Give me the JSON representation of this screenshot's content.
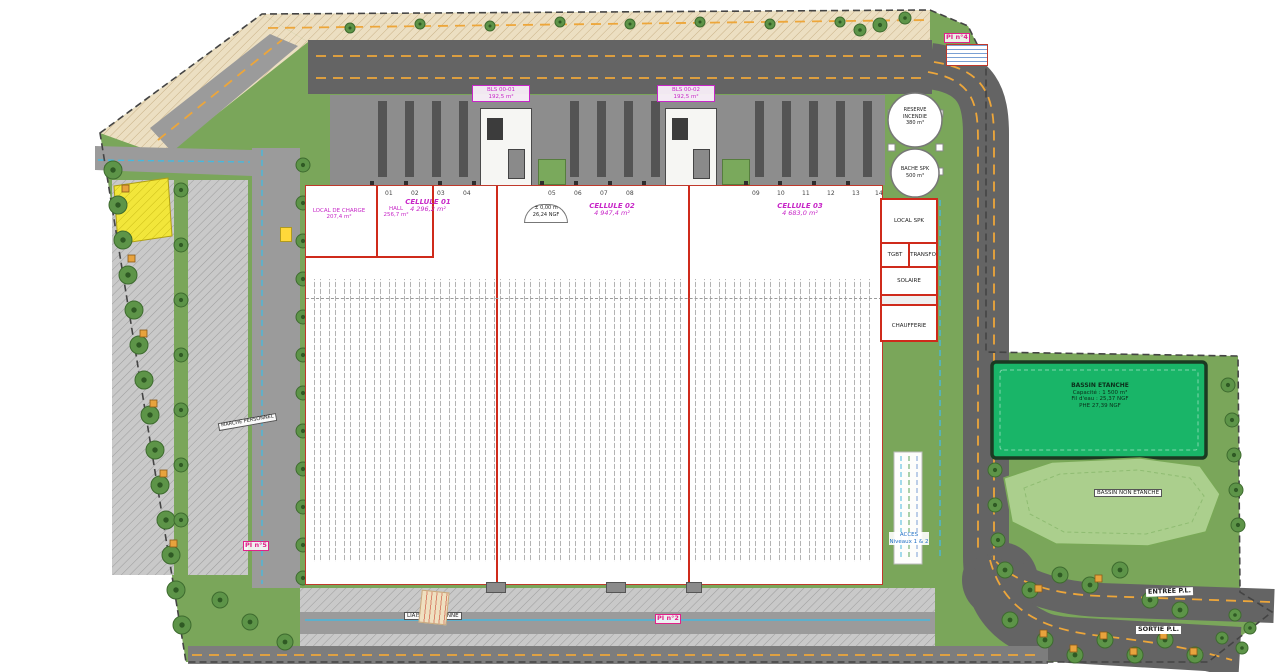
{
  "colors": {
    "wall_red": "#cf2a1b",
    "label_magenta": "#c726c7",
    "hydrant_pink": "#e0218a",
    "basin_green": "#19b568",
    "road_orange": "#eda63a",
    "path_cyan": "#49b8dc",
    "grass_green": "#7aa65a"
  },
  "building": {
    "cells": [
      {
        "name": "CELLULE 01",
        "area": "4 296,2 m²"
      },
      {
        "name": "CELLULE 02",
        "area": "4 947,4 m²"
      },
      {
        "name": "CELLULE 03",
        "area": "4 683,0 m²"
      }
    ],
    "local_charge": {
      "name": "LOCAL DE CHARGE",
      "area": "207,4 m²"
    },
    "hall": {
      "name": "HALL",
      "area": "256,7 m²"
    },
    "bls1": {
      "name": "BLS 00-01",
      "area": "192,5 m²"
    },
    "bls2": {
      "name": "BLS 00-02",
      "area": "192,5 m²"
    },
    "rooms": {
      "local_spk": "LOCAL SPK",
      "tgbt": "TGBT",
      "transfo": "TRANSFO",
      "solaire": "SOLAIRE",
      "chaufferie": "CHAUFFERIE"
    },
    "level": {
      "l1": "± 0,00 m",
      "l2": "26,24 NGF"
    },
    "docks": [
      "01",
      "02",
      "03",
      "04",
      "05",
      "06",
      "07",
      "08",
      "09",
      "10",
      "11",
      "12",
      "13",
      "14"
    ]
  },
  "tanks": {
    "reserve": {
      "l1": "RESERVE",
      "l2": "INCENDIE",
      "vol": "380 m³"
    },
    "bache": {
      "l1": "BACHE SPK",
      "vol": "500 m³"
    }
  },
  "basins": {
    "etanche": {
      "l1": "BASSIN ETANCHE",
      "l2": "Capacité : 1 500 m³",
      "l3": "Fil d'eau : 25,37 NGF",
      "l4": "PHE 27,39 NGF"
    },
    "non_etanche": "BASSIN NON ETANCHE"
  },
  "roads": {
    "entree": "ENTREE P.L.",
    "sortie": "SORTIE P.L."
  },
  "access": {
    "l1": "ACCES",
    "l2": "Niveaux 1 & 2"
  },
  "hydrants": {
    "pi2": "PI n°2",
    "pi4": "PI n°4",
    "pi5": "PI n°5"
  },
  "paths": {
    "pieton": "LIAISON PIETONNE",
    "personnel": "MARCHE PERSONNEL"
  }
}
